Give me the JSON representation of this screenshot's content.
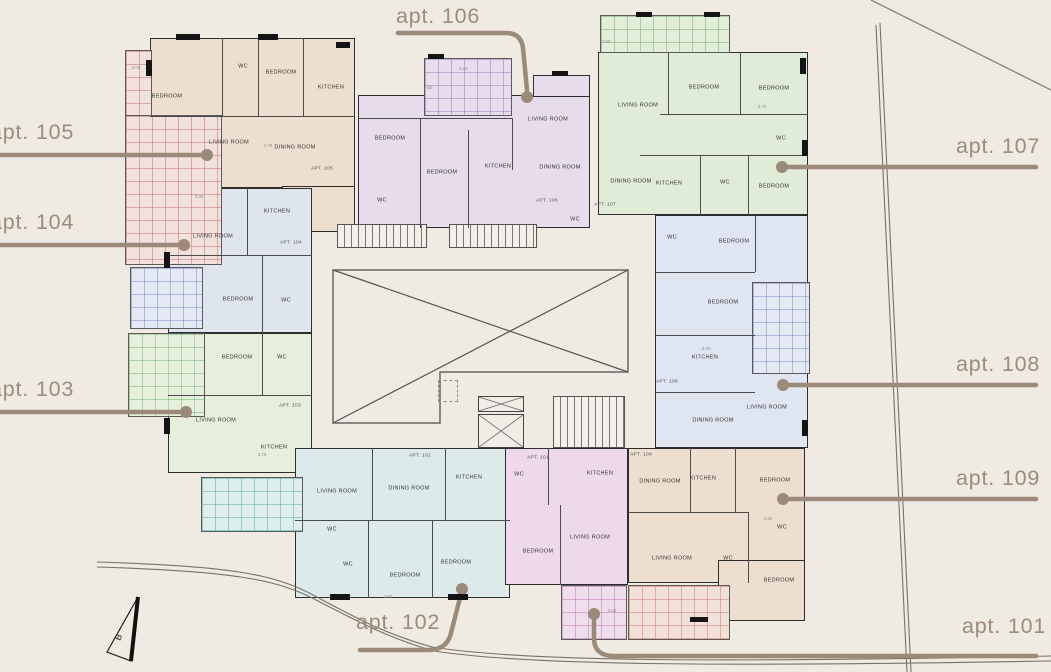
{
  "palette": {
    "background": "#efeae2",
    "wall": "#2e2e2e",
    "callout_text": "#9c8c7c",
    "leader_line": "#9b8a79",
    "apartment_fills": {
      "apt101": "#eed9ec",
      "apt102": "#ddeaea",
      "apt103": "#e7eedb",
      "apt104": "#dfe5ef",
      "apt105": "#ecdfd0",
      "apt106": "#e7dcec",
      "apt107": "#e0ebd8",
      "apt108": "#e0e5f2",
      "apt109": "#ecdfd0"
    }
  },
  "callouts": {
    "apt101": "apt. 101",
    "apt102": "apt. 102",
    "apt103": "apt. 103",
    "apt104": "apt. 104",
    "apt105": "apt. 105",
    "apt106": "apt. 106",
    "apt107": "apt. 107",
    "apt108": "apt. 108",
    "apt109": "apt. 109"
  },
  "room_names": {
    "bedroom": "BEDROOM",
    "living_room": "LIVING ROOM",
    "dining_room": "DINING ROOM",
    "kitchen": "KITCHEN",
    "wc": "WC"
  },
  "unit_ids": {
    "apt101": "APT. 101",
    "apt102": "APT. 102",
    "apt103": "APT. 103",
    "apt104": "APT. 104",
    "apt105": "APT. 105",
    "apt106": "APT. 106",
    "apt107": "APT. 107",
    "apt108": "APT. 108",
    "apt109": "APT. 109"
  },
  "dims": {
    "d1": "3.00",
    "d2": "3.75",
    "d3": "4.20",
    "d4": "2.50",
    "d5": "2.90",
    "d6": "3.70",
    "d7": "3.20",
    "d8": "3.65",
    "d9": "2.65",
    "d10": "2.50",
    "d11": "3.05",
    "d12": "3.75"
  },
  "compass": {
    "label": "B"
  }
}
